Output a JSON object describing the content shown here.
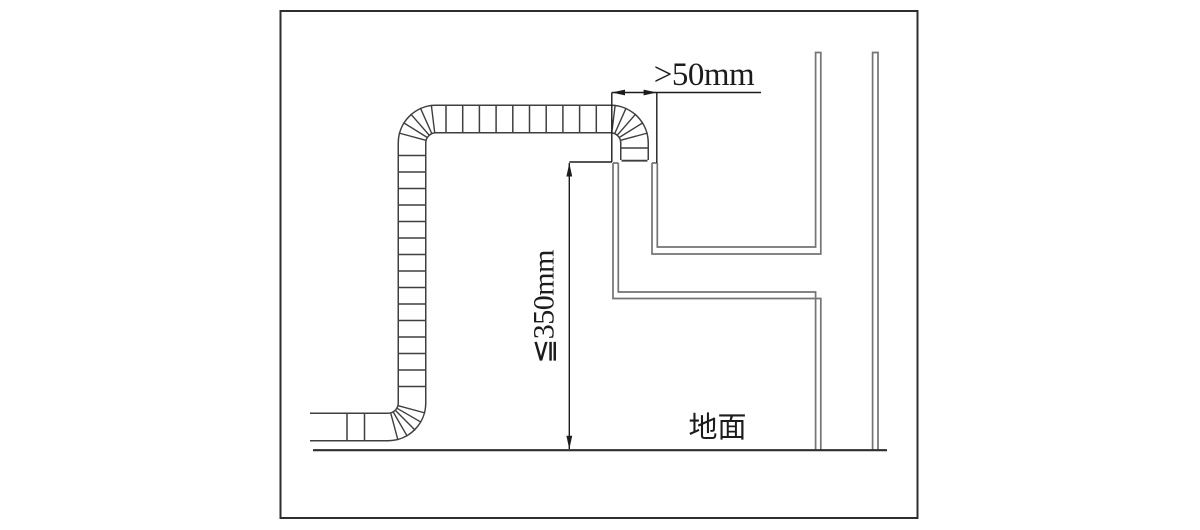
{
  "diagram": {
    "type": "flue-pipe-installation-diagram",
    "labels": {
      "clearance": ">50mm",
      "max_height": "≦350mm",
      "ground": "地面"
    },
    "values": {
      "clearance_mm": "greater than 50",
      "max_height_mm": "less than or equal to 350"
    },
    "colors": {
      "background": "#ffffff",
      "border": "#2e2e2e",
      "pipe": "#3f3f3f",
      "wall": "#747474",
      "annotation": "#1c1c1c"
    }
  }
}
